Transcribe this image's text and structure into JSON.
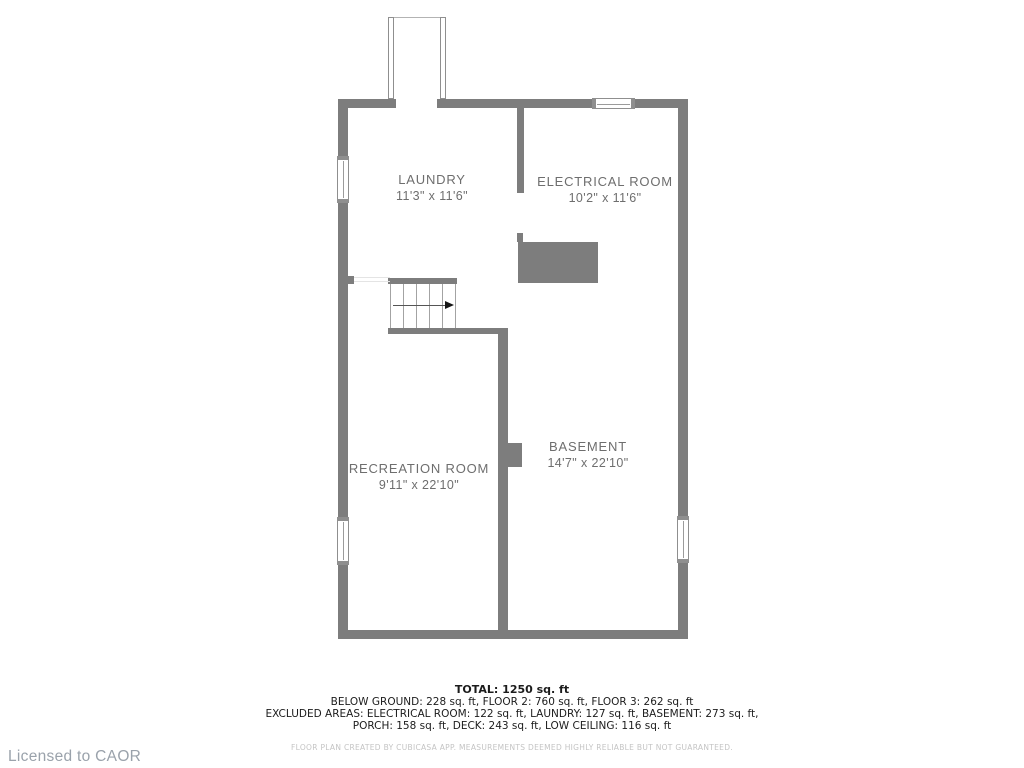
{
  "colors": {
    "wall": "#7d7d7d",
    "room_text": "#6e6e6e",
    "summary_text": "#1c1c1c",
    "disclaimer_text": "#c4c4c4",
    "license_text": "#9aa2ab"
  },
  "floorplan": {
    "rooms": [
      {
        "id": "laundry",
        "name": "LAUNDRY",
        "dimensions": "11'3\" x 11'6\""
      },
      {
        "id": "electrical-room",
        "name": "ELECTRICAL ROOM",
        "dimensions": "10'2\" x 11'6\""
      },
      {
        "id": "recreation-room",
        "name": "RECREATION ROOM",
        "dimensions": "9'11\" x 22'10\""
      },
      {
        "id": "basement",
        "name": "BASEMENT",
        "dimensions": "14'7\" x 22'10\""
      }
    ],
    "stairs": {
      "direction": "up-right"
    },
    "windows": [
      "left-upper",
      "left-lower",
      "right-lower",
      "top-right"
    ]
  },
  "summary": {
    "total": "TOTAL: 1250 sq. ft",
    "line1": "BELOW GROUND: 228 sq. ft, FLOOR 2: 760 sq. ft, FLOOR 3: 262 sq. ft",
    "line2": "EXCLUDED AREAS: ELECTRICAL ROOM: 122 sq. ft, LAUNDRY: 127 sq. ft, BASEMENT: 273 sq. ft,",
    "line3": "PORCH: 158 sq. ft, DECK: 243 sq. ft, LOW CEILING: 116 sq. ft",
    "disclaimer": "FLOOR PLAN CREATED BY CUBICASA APP. MEASUREMENTS DEEMED HIGHLY RELIABLE BUT NOT GUARANTEED."
  },
  "license": "Licensed to CAOR"
}
